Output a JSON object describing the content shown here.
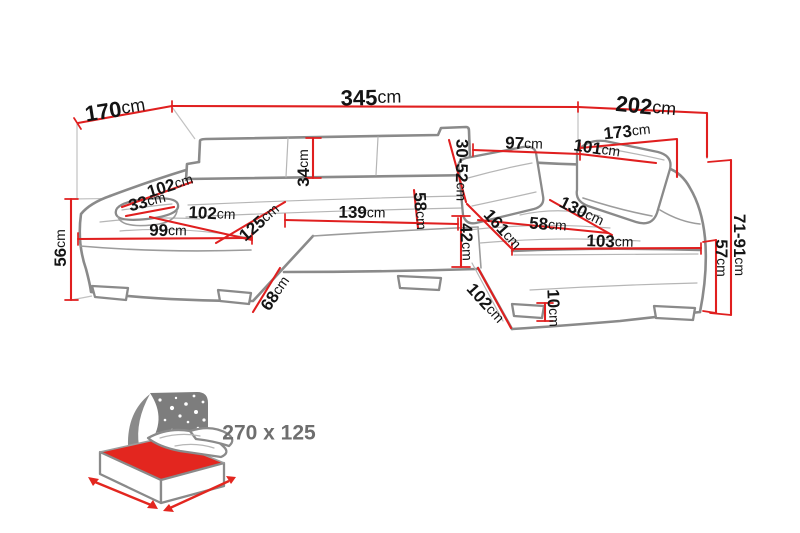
{
  "diagram": {
    "type": "corner-sofa-dimension-diagram",
    "unit_default": "cm",
    "colors": {
      "dimension_line": "#e01f1f",
      "sofa_outline": "#8a8a8a",
      "label_text": "#141414",
      "bed_icon_red": "#e3261f",
      "bed_headboard_gray": "#7d7d7d",
      "bed_size_text": "#6e6e6e"
    },
    "dims": {
      "depth_left_total": {
        "value": "170",
        "unit": "cm"
      },
      "width_total": {
        "value": "345",
        "unit": "cm"
      },
      "depth_right_total": {
        "value": "202",
        "unit": "cm"
      },
      "width_right": {
        "value": "173",
        "unit": "cm"
      },
      "back_section_left": {
        "value": "97",
        "unit": "cm"
      },
      "back_section_right": {
        "value": "101",
        "unit": "cm"
      },
      "backrest_height_adjustable": {
        "value": "30-52",
        "unit": "cm"
      },
      "backrest_height": {
        "value": "34",
        "unit": "cm"
      },
      "arm_back_diagonal": {
        "value": "102",
        "unit": "cm"
      },
      "armrest_pillow": {
        "value": "33",
        "unit": "cm"
      },
      "seat_depth_left": {
        "value": "102",
        "unit": "cm"
      },
      "chaise_left_width": {
        "value": "99",
        "unit": "cm"
      },
      "chaise_left_diagonal": {
        "value": "125",
        "unit": "cm"
      },
      "seat_width_middle": {
        "value": "139",
        "unit": "cm"
      },
      "seat_depth_middle": {
        "value": "58",
        "unit": "cm"
      },
      "seat_front_height": {
        "value": "42",
        "unit": "cm"
      },
      "seat_width_right": {
        "value": "58",
        "unit": "cm"
      },
      "chaise_right_diagonal": {
        "value": "161",
        "unit": "cm"
      },
      "chaise_right_length": {
        "value": "130",
        "unit": "cm"
      },
      "chaise_right_width": {
        "value": "103",
        "unit": "cm"
      },
      "side_height_left": {
        "value": "56",
        "unit": "cm"
      },
      "front_depth_left": {
        "value": "68",
        "unit": "cm"
      },
      "front_depth_right": {
        "value": "102",
        "unit": "cm"
      },
      "leg_height": {
        "value": "10",
        "unit": "cm"
      },
      "back_height_right": {
        "value": "71-91",
        "unit": "cm"
      },
      "seat_height_right": {
        "value": "57",
        "unit": "cm"
      }
    },
    "bed_function": {
      "size_label": "270 x 125"
    }
  }
}
